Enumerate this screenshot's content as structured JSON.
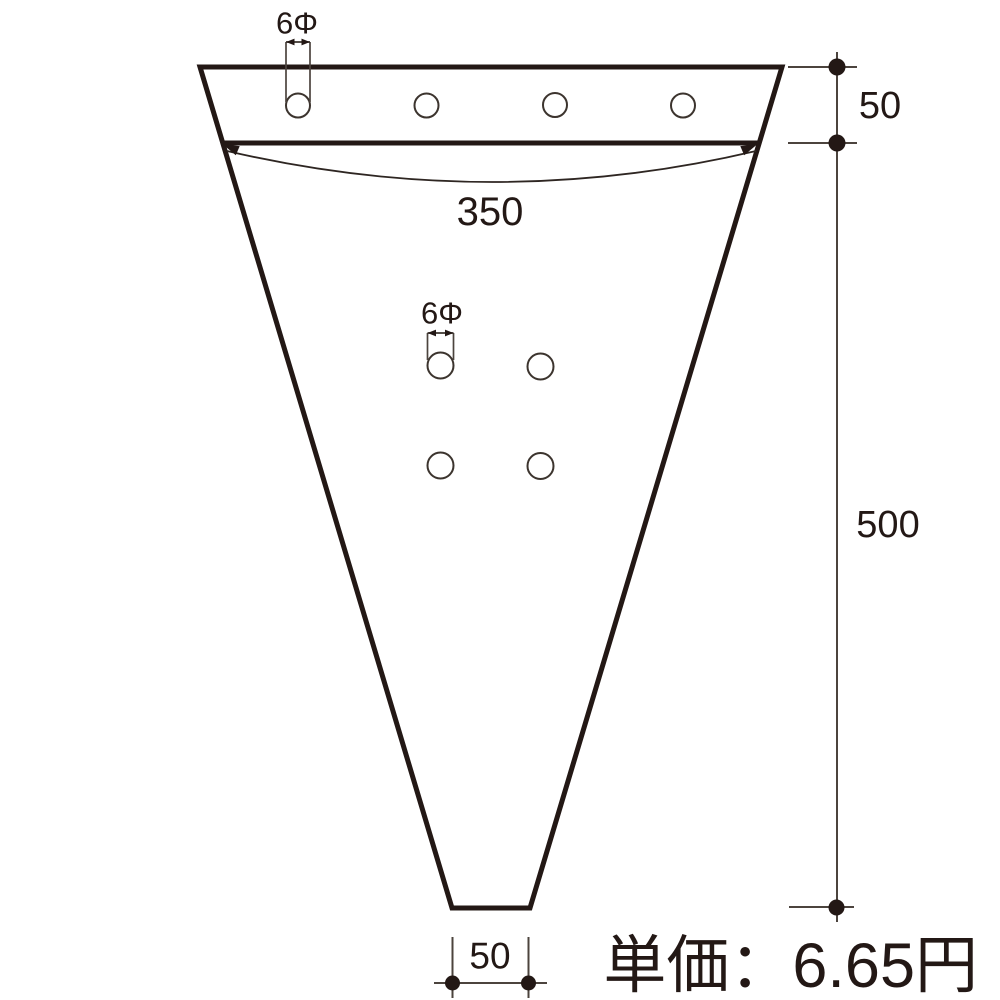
{
  "drawing": {
    "background_color": "#ffffff",
    "outline_color": "#231815",
    "thin_line_color": "#4c443e",
    "dot_color": "#231815",
    "labels": {
      "top_hole_diameter": "6Φ",
      "mid_hole_diameter": "6Φ",
      "top_width": "350",
      "band_height": "50",
      "body_height": "500",
      "bottom_width": "50"
    },
    "dimensions": {
      "top_width_value": 350,
      "band_height_value": 50,
      "body_height_value": 500,
      "bottom_width_value": 50,
      "hole_diameter_value": 6
    },
    "price_text": "単価：6.65円"
  }
}
